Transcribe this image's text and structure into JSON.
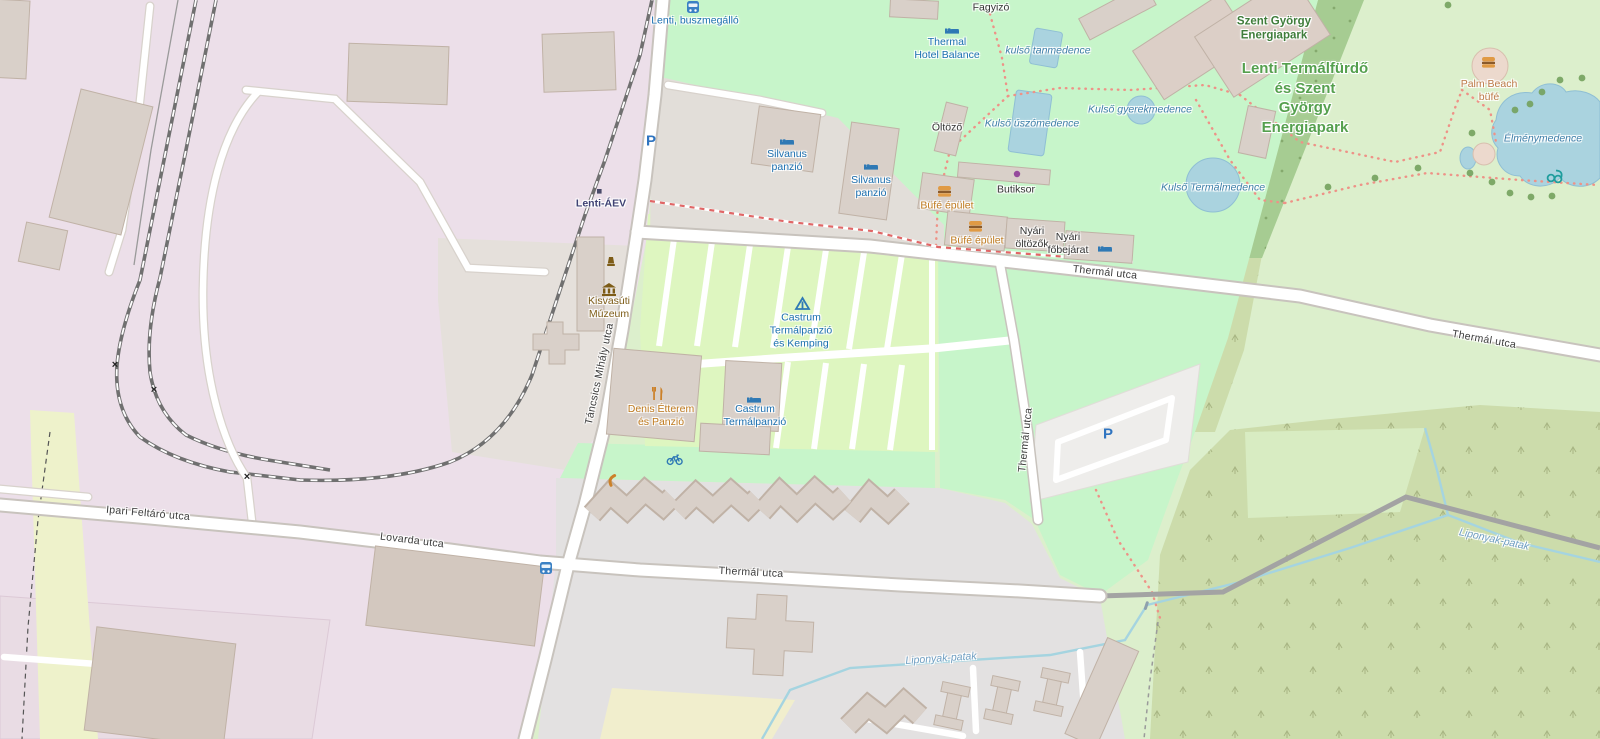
{
  "map": {
    "kind": "openstreetmap-style map render, Lenti thermal bath area (Hungary)"
  },
  "colors": {
    "park_mint": "#c7f5ca",
    "grass_pale": "#dcefcc",
    "camp_site": "#def6c0",
    "scrub": "#ccdcab",
    "forest": "#a6cc92",
    "industrial_pink": "#ecdfe9",
    "building": "#d9d0c9",
    "water": "#aad3df",
    "gray_area": "#e3e1e1",
    "poi_blue": "#1a6fb0",
    "amenity_orange": "#bf7a1e",
    "park_label_green": "#55a04e",
    "parking_blue": "#2f74c0"
  },
  "labels": {
    "bus_stop_north": "Lenti, buszmegálló",
    "hotel_balance": "Thermal\nHotel Balance",
    "fagyizo": "Fagyizó",
    "kulso_tanmedence": "kulső tanmedence",
    "kulso_uszomedence": "Kulső úszómedence",
    "kulso_gyerekmedence": "Kulső gyerekmedence",
    "kulso_termalmedence": "Kulső Termálmedence",
    "oltozo": "Öltöző",
    "butiksor": "Butiksor",
    "szent_gyorgy": "Szent György\nEnergiapark",
    "lenti_termalfurdo": "Lenti Termálfürdő\nés Szent\nGyörgy\nEnergiapark",
    "palm_beach": "Palm Beach\nbüfé",
    "elmenymedence": "Élménymedence",
    "silvanus_1": "Silvanus\npanzió",
    "silvanus_2": "Silvanus\npanzió",
    "bufe_1": "Büfé épület",
    "bufe_2": "Büfé épület",
    "nyari_oltozok": "Nyári\nöltözők",
    "nyari_fobejarat": "Nyári\nfőbejárat",
    "lenti_aev": "Lenti-ÁEV",
    "kisvasuti": "Kisvasúti\nMúzeum",
    "castrum_kemping": "Castrum\nTermálpanzió\nés Kemping",
    "denis": "Denis Étterem\nés Panzió",
    "castrum_panzio": "Castrum\nTermálpanzió",
    "parking_p": "P",
    "crossing": "×"
  },
  "streets": {
    "tancsics": "Táncsics Mihály utca",
    "thermal": "Thermál utca",
    "ipari": "Ipari Feltáró utca",
    "lovarda": "Lovarda utca",
    "liponyak": "Liponyak-patak"
  }
}
